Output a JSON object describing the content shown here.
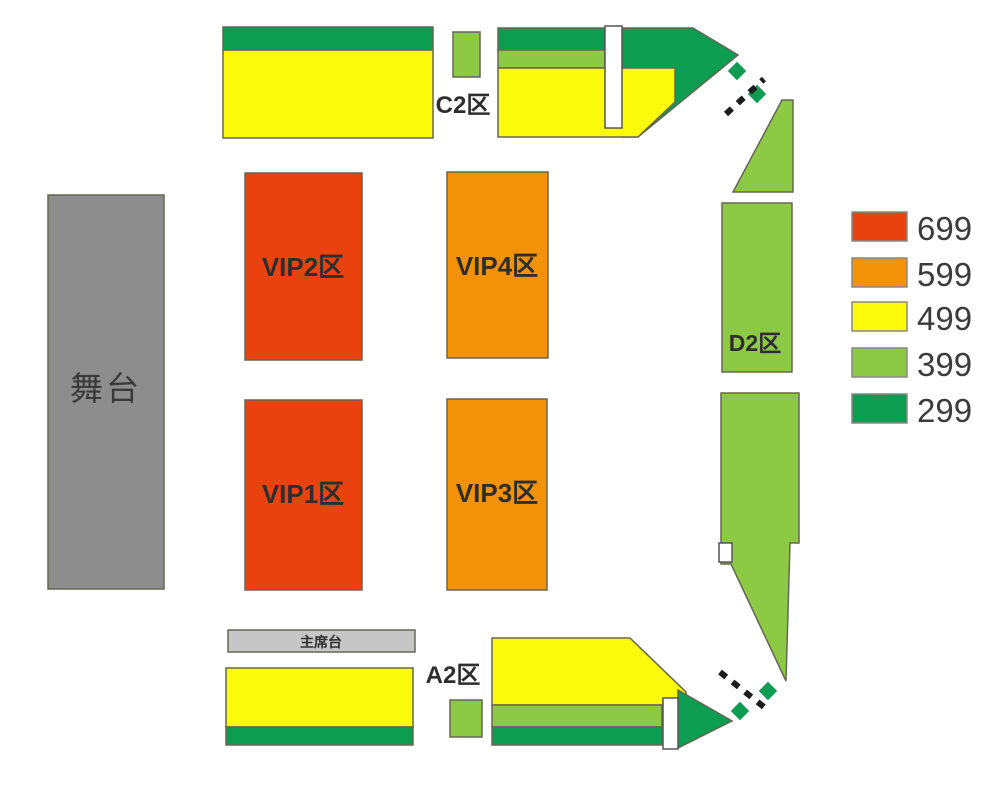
{
  "stage": {
    "label": "舞台"
  },
  "podium": {
    "label": "主席台"
  },
  "sections": {
    "vip1": {
      "label": "VIP1区"
    },
    "vip2": {
      "label": "VIP2区"
    },
    "vip3": {
      "label": "VIP3区"
    },
    "vip4": {
      "label": "VIP4区"
    },
    "a2": {
      "label": "A2区"
    },
    "c2": {
      "label": "C2区"
    },
    "d2": {
      "label": "D2区"
    }
  },
  "legend": {
    "items": [
      {
        "price": "699",
        "color": "#e8420e"
      },
      {
        "price": "599",
        "color": "#f39208"
      },
      {
        "price": "499",
        "color": "#fafa0a"
      },
      {
        "price": "399",
        "color": "#8dc944"
      },
      {
        "price": "299",
        "color": "#0c9c52"
      }
    ]
  },
  "colors": {
    "tier699": "#e8420e",
    "tier599": "#f39208",
    "tier499": "#fafa0a",
    "tier399": "#8dc944",
    "tier299": "#0c9c52",
    "stage": "#8d8d8d",
    "podium": "#c6c6c6",
    "dash": "#1c1c1c"
  }
}
